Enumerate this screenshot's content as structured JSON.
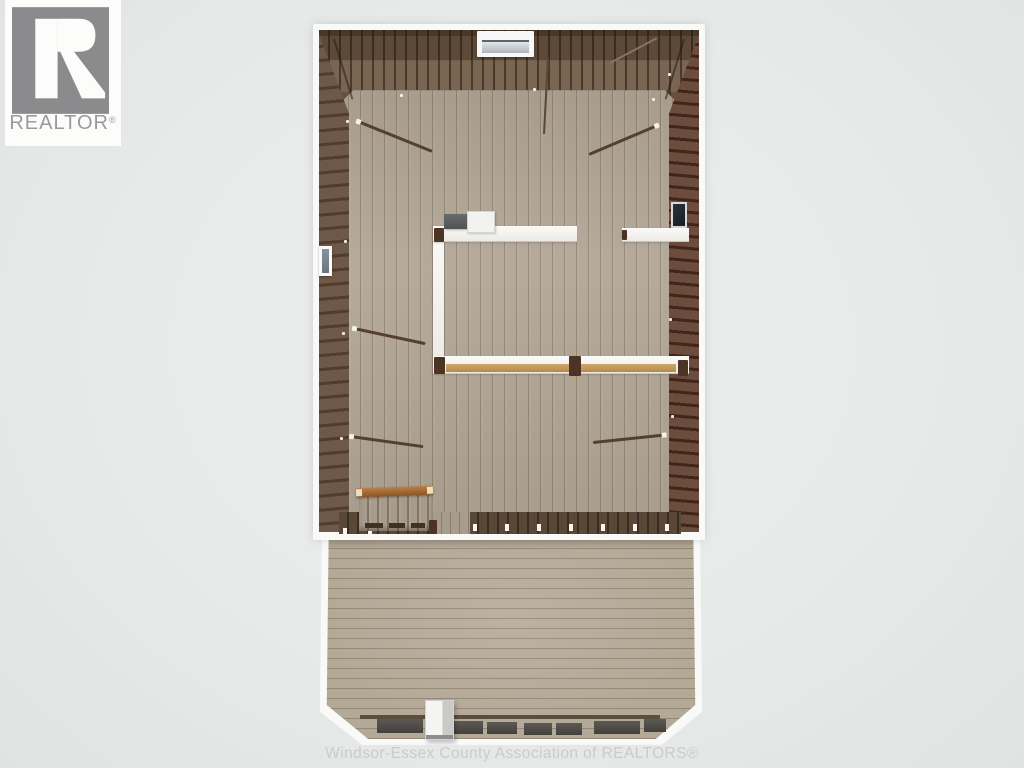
{
  "branding": {
    "logo_label": "REALTOR",
    "registered_mark": "®",
    "watermark_text": "Windsor-Essex County Association of REALTORS®"
  },
  "scene": {
    "type": "3d-dollhouse-floorplan-render",
    "areas": [
      "upper-level-open-room",
      "interior-partition-room",
      "staircase",
      "rear-deck"
    ],
    "palette": {
      "background": "#e8eaea",
      "wall_outline": "#f9f9f7",
      "roof_planks_dark": "#53402f",
      "roof_planks_mid": "#75604d",
      "brick_trim": "#6b4c3d",
      "floor_wood": "#afa494",
      "deck_wood": "#b3a997",
      "stair_rail": "#a96f34",
      "top_plate_tan": "#c99f63",
      "logo_gray": "#8b8b8d",
      "logo_text_gray": "#9a9a9b",
      "watermark_gray": "#c9ccca"
    }
  }
}
